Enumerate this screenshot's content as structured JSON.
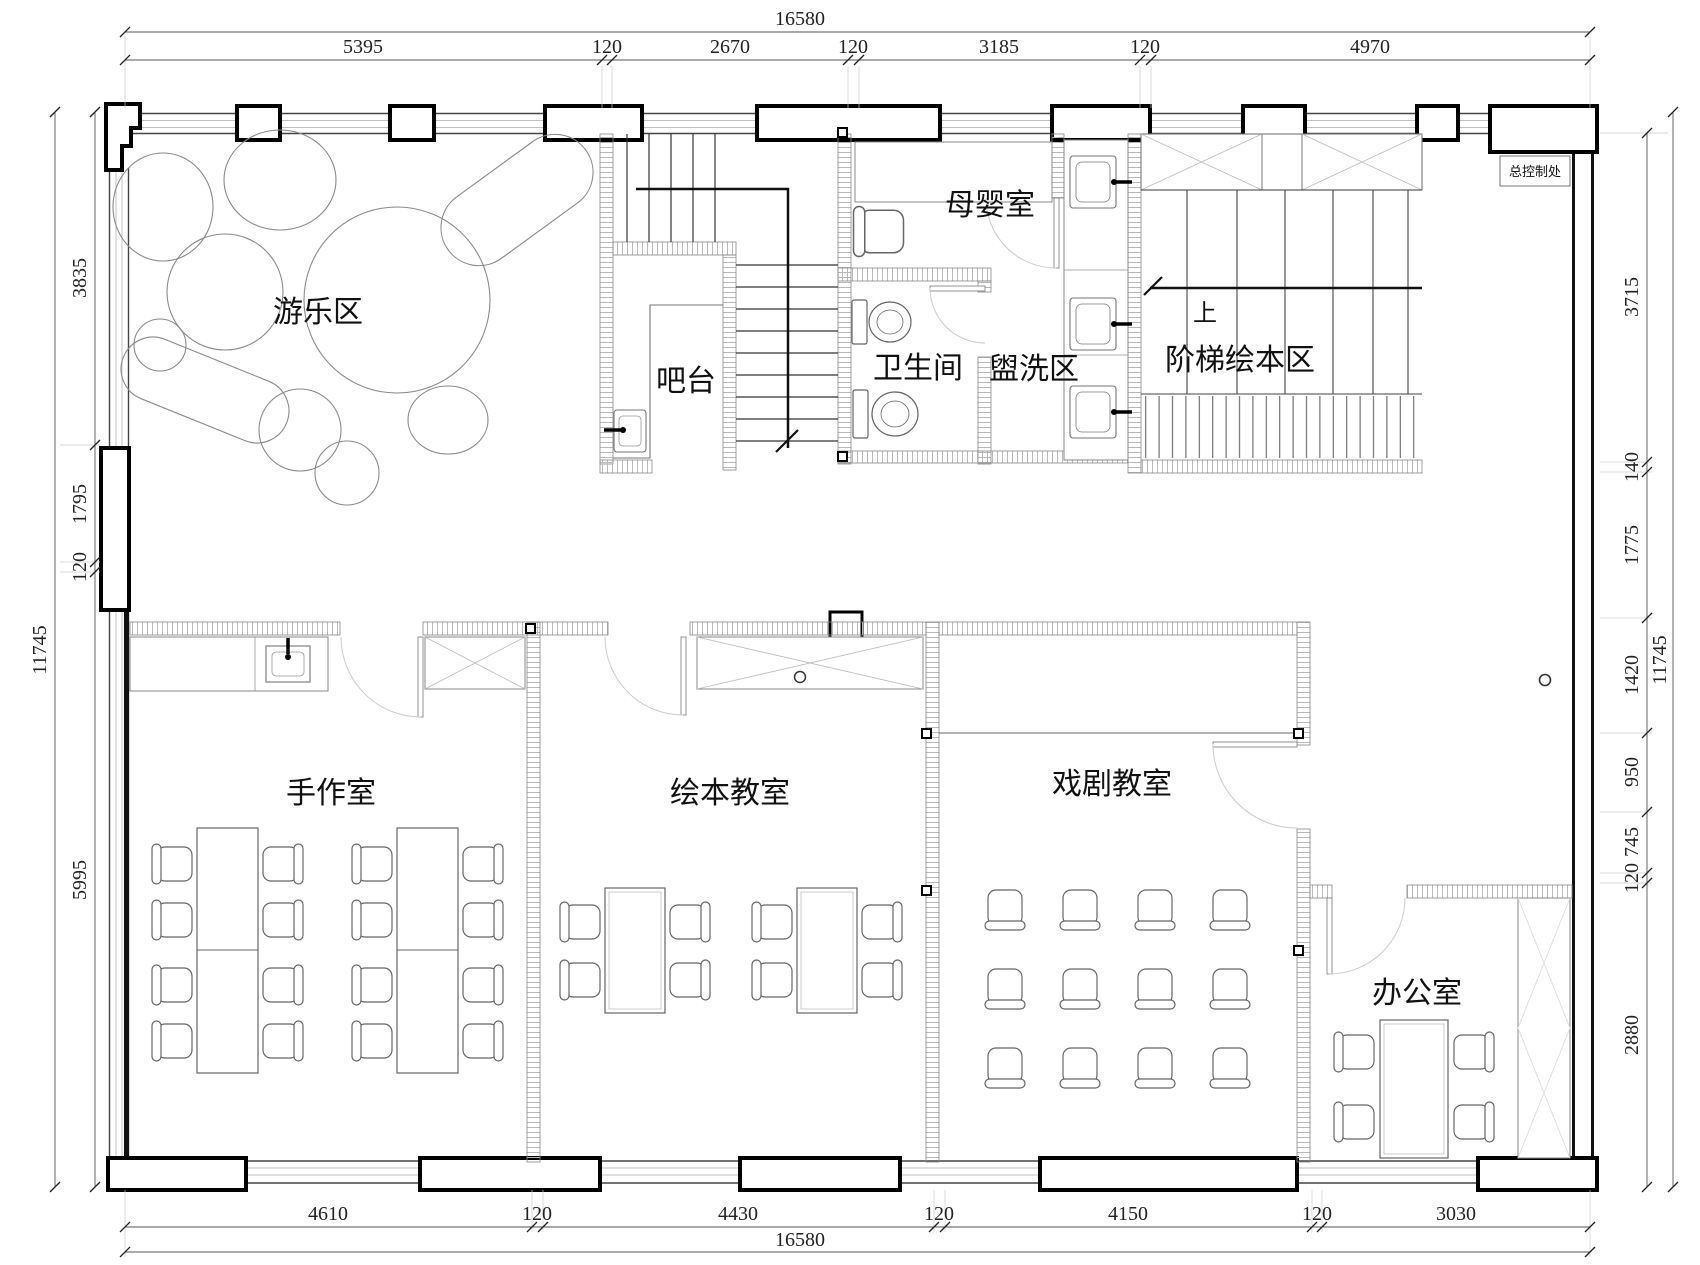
{
  "rooms": {
    "play_area": "游乐区",
    "bar": "吧台",
    "nursing_room": "母婴室",
    "toilet": "卫生间",
    "wash_area": "盥洗区",
    "stepped_reading_area": "阶梯绘本区",
    "up_mark": "上",
    "master_control": "总控制处",
    "handcraft_room": "手作室",
    "picture_book_classroom": "绘本教室",
    "drama_classroom": "戏剧教室",
    "office": "办公室"
  },
  "dimensions": {
    "top_total": "16580",
    "top_segments": [
      "5395",
      "120",
      "2670",
      "120",
      "3185",
      "120",
      "4970"
    ],
    "bottom_segments": [
      "4610",
      "120",
      "4430",
      "120",
      "4150",
      "120",
      "3030"
    ],
    "bottom_total": "16580",
    "left_total": "11745",
    "left_segments": [
      "3835",
      "1795",
      "120",
      "5995"
    ],
    "right_segments": [
      "3715",
      "140",
      "1775",
      "1420",
      "950",
      "745",
      "120",
      "2880"
    ],
    "right_total": "11745"
  },
  "colors": {
    "line": "#111111",
    "wall_hatch": "#b8b8b8",
    "furniture": "#666666",
    "dim_text": "#222222"
  }
}
